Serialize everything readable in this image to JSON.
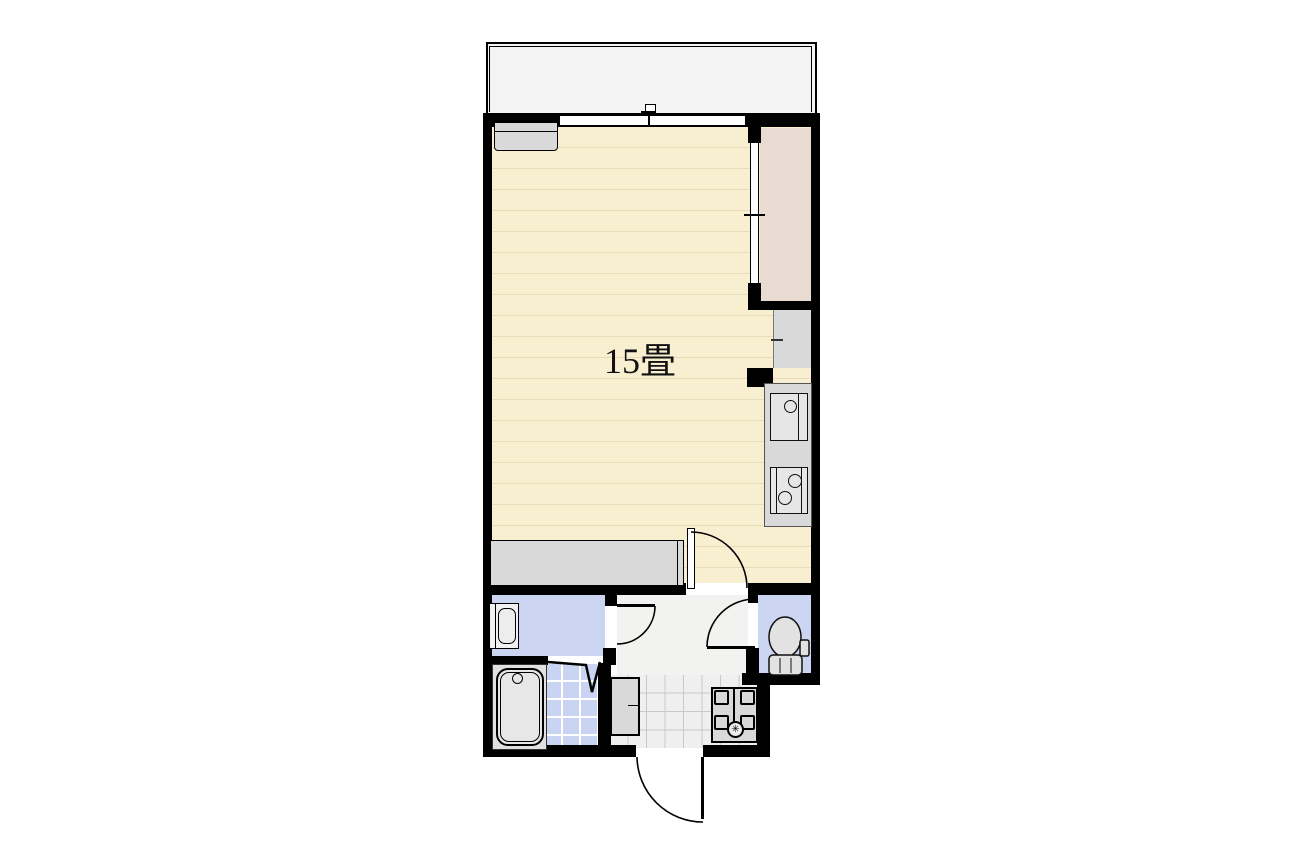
{
  "rooms": {
    "main": {
      "label": "15畳"
    }
  },
  "fixtures": [
    "balcony",
    "sliding-window",
    "wall-cabinet",
    "closet",
    "refrigerator-space",
    "kitchen-sink",
    "gas-stove",
    "storage-counter",
    "washbasin",
    "bathtub",
    "bath-folding-door",
    "toilet",
    "shoe-cabinet",
    "washing-machine-pan",
    "entrance-door"
  ],
  "colors": {
    "wall": "#000000",
    "floor": "#F8EFD1",
    "floor-line": "#E8DCB8",
    "closet": "#E9DAD2",
    "water": "#CBD5F2",
    "tile": "#C9D4F2",
    "counter": "#D9D9D9",
    "fixture": "#E6E6E6",
    "balcony": "#F3F3F3",
    "hallway": "#F2F2F1",
    "entrance": "#EFEFEF",
    "grid": "#C8C8C8"
  }
}
